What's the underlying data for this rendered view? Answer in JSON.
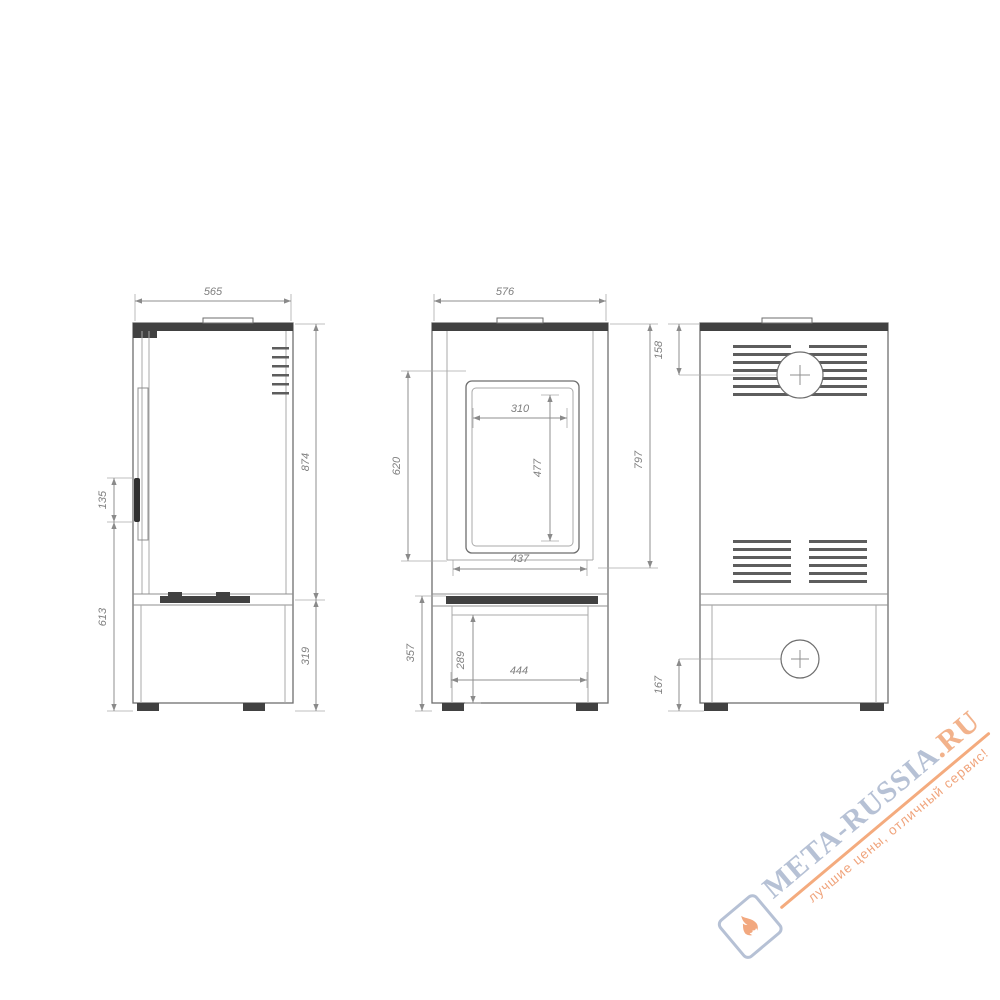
{
  "drawing": {
    "type": "technical-drawing",
    "subject": "free-standing stove: three orthographic views with millimetre dimensions",
    "views": [
      {
        "name": "side-view",
        "dimensions": {
          "width_top": "565",
          "handle_length": "135",
          "handle_to_floor": "613",
          "body_height": "874",
          "base_height": "319"
        }
      },
      {
        "name": "front-view",
        "dimensions": {
          "width_top": "576",
          "door_span": "620",
          "glass_width": "310",
          "glass_height": "477",
          "body_right_height": "797",
          "door_width": "437",
          "base_height": "357",
          "drawer_height": "289",
          "drawer_width": "444"
        }
      },
      {
        "name": "back-view",
        "dimensions": {
          "flue_center_from_top": "158",
          "outlet_center_from_floor": "167"
        }
      }
    ]
  },
  "watermark": {
    "brand": "META-RUSSIA",
    "tld": ".RU",
    "tagline": "лучшие цены, отличный сервис!",
    "logo_icon": "flame-icon",
    "brand_color": "#b6c1d5",
    "accent_color": "#f2a87f"
  }
}
